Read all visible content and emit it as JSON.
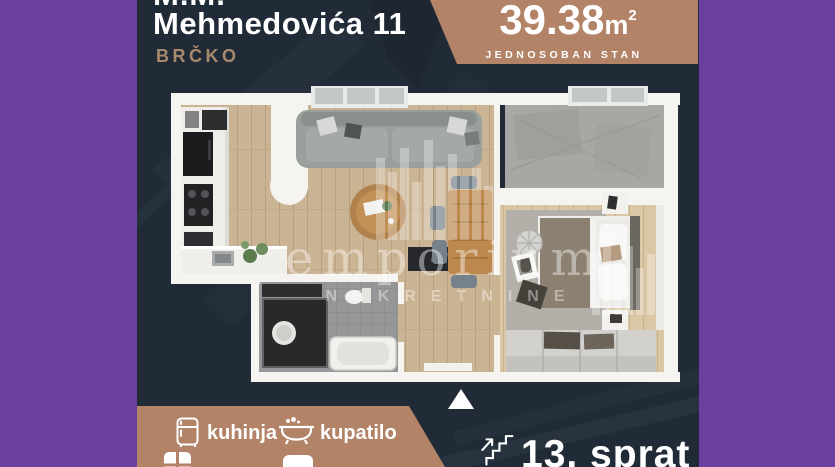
{
  "header": {
    "line1_partial": "M.M.",
    "address": "Mehmedovića 11",
    "city": "BRČKO"
  },
  "badge": {
    "area_value": "39.38",
    "area_unit": "m",
    "area_sup": "2",
    "subtitle": "JEDNOSOBAN STAN"
  },
  "watermark": {
    "brand": "emporium",
    "subtitle": "NEKRETNINE"
  },
  "features": {
    "items": [
      {
        "icon": "fridge-icon",
        "label": "kuhinja"
      },
      {
        "icon": "bathtub-icon",
        "label": "kupatilo"
      }
    ],
    "partial_row_icons": [
      "window-icon",
      "furniture-icon"
    ]
  },
  "floor": {
    "icon": "stairs-icon",
    "label": "13. sprat"
  },
  "compass": {
    "icon": "north-triangle-icon"
  },
  "colors": {
    "purple": "#6a3f9d",
    "background": "#212b37",
    "stripe": "#2a3441",
    "accent_tan": "#b28367",
    "city_text": "#a8896c",
    "text": "#ffffff"
  }
}
